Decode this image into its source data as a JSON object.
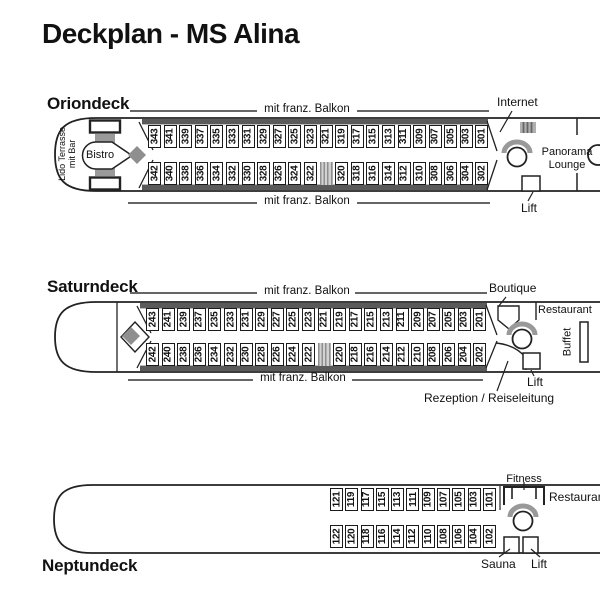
{
  "title": "Deckplan - MS Alina",
  "decks": {
    "orion": {
      "name": "Oriondeck",
      "balkon_top": "mit franz. Balkon",
      "balkon_bottom": "mit franz. Balkon",
      "lido": "Lido Terrasse mit Bar",
      "bistro": "Bistro",
      "internet": "Internet",
      "panorama_lounge": "Panorama Lounge",
      "lift": "Lift",
      "cabins_top": [
        "343",
        "341",
        "339",
        "337",
        "335",
        "333",
        "331",
        "329",
        "327",
        "325",
        "323",
        "321",
        "319",
        "317",
        "315",
        "313",
        "311",
        "309",
        "307",
        "305",
        "303",
        "301"
      ],
      "cabins_bottom": [
        "342",
        "340",
        "338",
        "336",
        "334",
        "332",
        "330",
        "328",
        "326",
        "324",
        "322",
        null,
        "320",
        "318",
        "316",
        "314",
        "312",
        "310",
        "308",
        "306",
        "304",
        "302"
      ]
    },
    "saturn": {
      "name": "Saturndeck",
      "balkon_top": "mit franz. Balkon",
      "balkon_bottom": "mit franz. Balkon",
      "boutique": "Boutique",
      "restaurant": "Restaurant",
      "buffet": "Buffet",
      "lift": "Lift",
      "rezeption": "Rezeption / Reiseleitung",
      "cabins_top": [
        "243",
        "241",
        "239",
        "237",
        "235",
        "233",
        "231",
        "229",
        "227",
        "225",
        "223",
        "221",
        "219",
        "217",
        "215",
        "213",
        "211",
        "209",
        "207",
        "205",
        "203",
        "201"
      ],
      "cabins_bottom": [
        "242",
        "240",
        "238",
        "236",
        "234",
        "232",
        "230",
        "228",
        "226",
        "224",
        "222",
        null,
        "220",
        "218",
        "216",
        "214",
        "212",
        "210",
        "208",
        "206",
        "204",
        "202"
      ]
    },
    "neptun": {
      "name": "Neptundeck",
      "fitness": "Fitness",
      "restaurant": "Restaurant",
      "sauna": "Sauna",
      "lift": "Lift",
      "cabins_top": [
        "121",
        "119",
        "117",
        "115",
        "113",
        "111",
        "109",
        "107",
        "105",
        "103",
        "101"
      ],
      "cabins_bottom": [
        "122",
        "120",
        "118",
        "116",
        "114",
        "112",
        "110",
        "108",
        "106",
        "104",
        "102"
      ]
    }
  }
}
